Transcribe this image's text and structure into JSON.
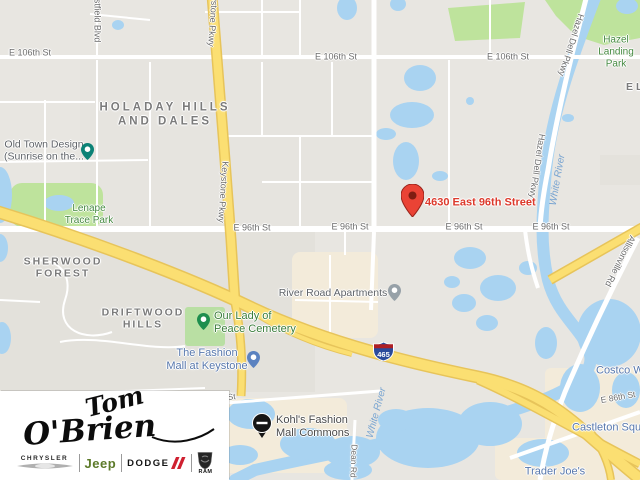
{
  "map": {
    "marker": {
      "address": "4630 East 96th Street"
    },
    "shield": {
      "route": "465"
    },
    "streets": {
      "e106_1": "E 106th St",
      "e106_2": "E 106th St",
      "e106_3": "E 106th St",
      "e96_1": "E 96th St",
      "e96_2": "E 96th St",
      "e96_3": "E 96th St",
      "e96_4": "E 96th St",
      "keystone_top": "Keystone Pkwy",
      "keystone_mid": "Keystone Pkwy",
      "westfield": "Westfield Blvd",
      "hazel_dell_1": "Hazel Dell Pkwy",
      "hazel_dell_2": "Hazel Dell Pkwy",
      "allisonville": "Allisonville Rd",
      "dean": "Dean Rd",
      "e86": "E 86th St",
      "partial_st": "h St"
    },
    "areas": {
      "holaday": "HOLADAY HILLS\nAND DALES",
      "sherwood": "SHERWOOD\nFOREST",
      "driftwood": "DRIFTWOOD\nHILLS",
      "el": "EL"
    },
    "parks": {
      "lenape": "Lenape\nTrace Park",
      "hazel_landing": "Hazel\nLanding Park"
    },
    "water": {
      "white_river_1": "White River",
      "white_river_2": "White River"
    },
    "pois": {
      "old_town": "Old Town Design\n(Sunrise on the...",
      "cemetery": "Our Lady of\nPeace Cemetery",
      "fashion_mall": "The Fashion\nMall at Keystone",
      "river_road": "River Road Apartments",
      "kohls": "Kohl's Fashion\nMall Commons",
      "trader_joes": "Trader Joe's",
      "castleton": "Castleton Square",
      "costco": "Costco Wholesale"
    },
    "colors": {
      "water": "#a9d3f1",
      "park": "#bee39c",
      "highway": "#fbdf72",
      "marker": "#ea4335",
      "address_text": "#dc3a2c",
      "shopping_blue": "#5878ad",
      "park_green": "#468a41"
    }
  },
  "logo": {
    "dealer_first": "Tom",
    "dealer_last": "O'Brien",
    "brands": {
      "chrysler": "CHRYSLER",
      "jeep": "Jeep",
      "dodge": "DODGE",
      "ram": "RAM"
    }
  }
}
